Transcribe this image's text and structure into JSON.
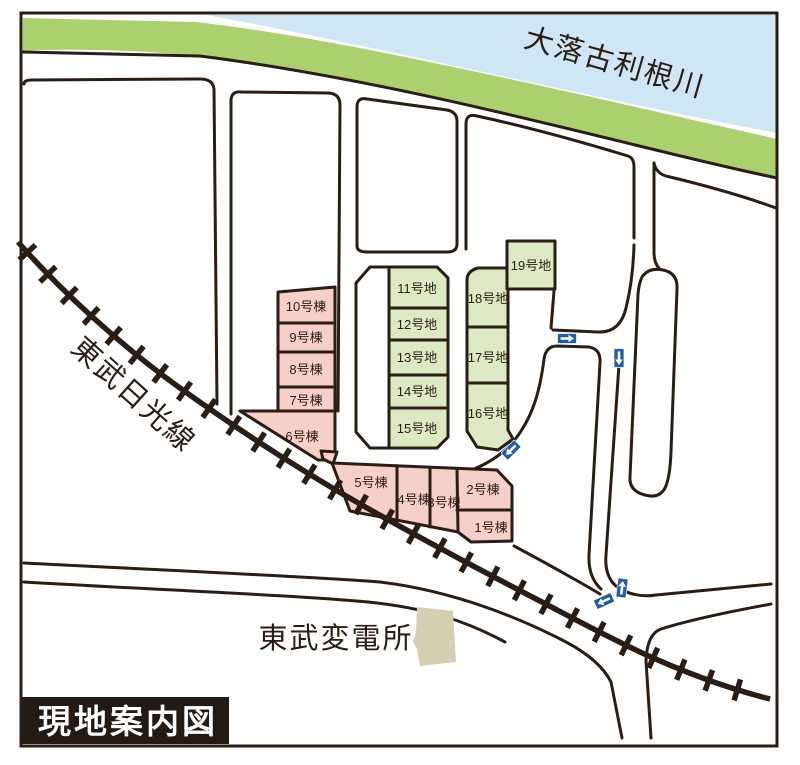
{
  "title": "現地案内図",
  "labels": {
    "river": "大落古利根川",
    "railway": "東武日光線",
    "substation": "東武変電所"
  },
  "lots": {
    "buildings": [
      {
        "label": "1号棟"
      },
      {
        "label": "2号棟"
      },
      {
        "label": "3号棟"
      },
      {
        "label": "4号棟"
      },
      {
        "label": "5号棟"
      },
      {
        "label": "6号棟"
      },
      {
        "label": "7号棟"
      },
      {
        "label": "8号棟"
      },
      {
        "label": "9号棟"
      },
      {
        "label": "10号棟"
      }
    ],
    "parcels": [
      {
        "label": "11号地"
      },
      {
        "label": "12号地"
      },
      {
        "label": "13号地"
      },
      {
        "label": "14号地"
      },
      {
        "label": "15号地"
      },
      {
        "label": "16号地"
      },
      {
        "label": "17号地"
      },
      {
        "label": "18号地"
      },
      {
        "label": "19号地"
      }
    ]
  },
  "one_way_arrows": [
    {
      "direction": "east"
    },
    {
      "direction": "south"
    },
    {
      "direction": "southwest"
    },
    {
      "direction": "north"
    },
    {
      "direction": "west"
    }
  ],
  "colors": {
    "river_blue": "#cfe7f5",
    "bank_green": "#abd06e",
    "building_pink": "#f7cfc9",
    "parcel_green": "#dde9c4",
    "substation_beige": "#d4cfb2",
    "line_dark": "#2a1e14",
    "arrow_blue": "#1a5db1",
    "title_bg": "#231a12",
    "title_text": "#ffffff"
  }
}
